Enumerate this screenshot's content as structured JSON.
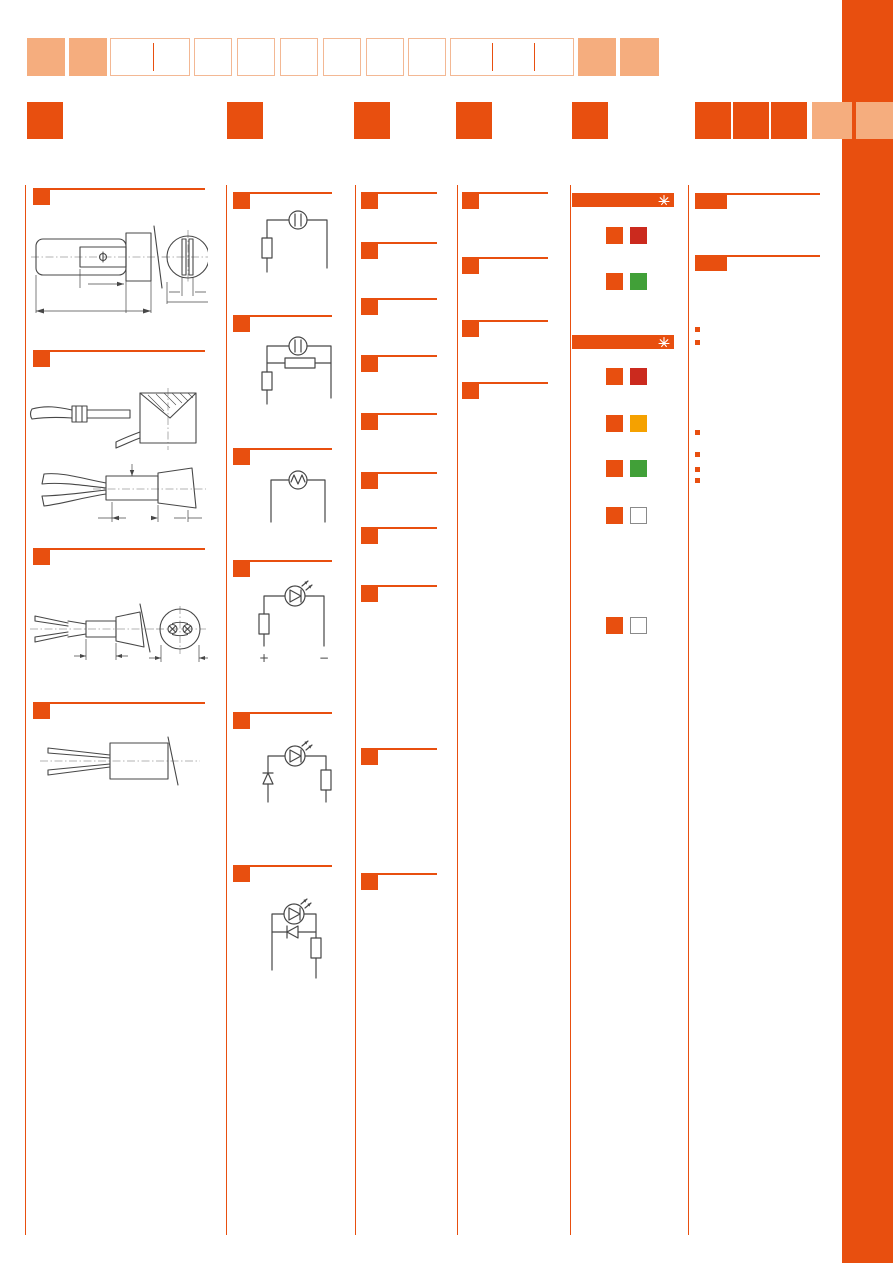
{
  "colors": {
    "accent": "#e84f0f",
    "accent_light": "#f5ad7e",
    "cell_outline": "#f3b894",
    "swatch_red": "#cb2a1e",
    "swatch_green": "#41a038",
    "swatch_amber": "#f5a100",
    "swatch_white": "#ffffff",
    "swatch_border": "#8a8a8a",
    "drawing_stroke": "#474747",
    "page_background": "#ffffff"
  },
  "top_nav": {
    "row1_cells": [
      {
        "style": "filled"
      },
      {
        "style": "filled"
      },
      {
        "style": "outlined",
        "span": 2
      },
      {
        "style": "outlined"
      },
      {
        "style": "outlined"
      },
      {
        "style": "outlined"
      },
      {
        "style": "outlined"
      },
      {
        "style": "outlined"
      },
      {
        "style": "outlined"
      },
      {
        "style": "outlined",
        "span": 3
      },
      {
        "style": "filled"
      },
      {
        "style": "filled"
      }
    ],
    "row2_accent_square_count": 8,
    "row2_light_square_count": 2
  },
  "columns": {
    "col1": {
      "sections": [
        {
          "marker": "orange-square",
          "drawing": "slide-base-lamp-side-and-end-view"
        },
        {
          "marker": "orange-square",
          "drawing": "wired-lamp-socket-two-views"
        },
        {
          "marker": "orange-square",
          "drawing": "wedge-base-lamp-side-and-end-view"
        },
        {
          "marker": "orange-square",
          "drawing": "bi-pin-lamp-side-view"
        }
      ]
    },
    "col2": {
      "sections": [
        {
          "marker": "orange-square",
          "circuit": "lamp-with-series-resistor"
        },
        {
          "marker": "orange-square",
          "circuit": "lamp-with-parallel-and-series-resistor"
        },
        {
          "marker": "orange-square",
          "circuit": "lamp-only"
        },
        {
          "marker": "orange-square",
          "circuit": "led-with-series-resistor",
          "plus_label": "+",
          "minus_label": "−"
        },
        {
          "marker": "orange-square",
          "circuit": "led-with-protection-diode-and-resistor"
        },
        {
          "marker": "orange-square",
          "circuit": "led-with-antiparallel-diode-and-resistor"
        }
      ]
    },
    "col3": {
      "section_marker_count": 10
    },
    "col4": {
      "section_marker_count": 4
    },
    "col5": {
      "banner1": {
        "icon": "sun-icon"
      },
      "banner1_swatch_rows": [
        [
          "accent",
          "red"
        ],
        [
          "accent",
          "green"
        ]
      ],
      "banner2": {
        "icon": "sun-icon"
      },
      "banner2_swatch_rows": [
        [
          "accent",
          "red"
        ],
        [
          "accent",
          "amber"
        ],
        [
          "accent",
          "green"
        ],
        [
          "accent",
          "white"
        ],
        [
          "accent",
          "white"
        ]
      ]
    },
    "col6": {
      "header_block_count": 2,
      "bullet_group1_count": 2,
      "bullet_group2_count": 4
    }
  }
}
